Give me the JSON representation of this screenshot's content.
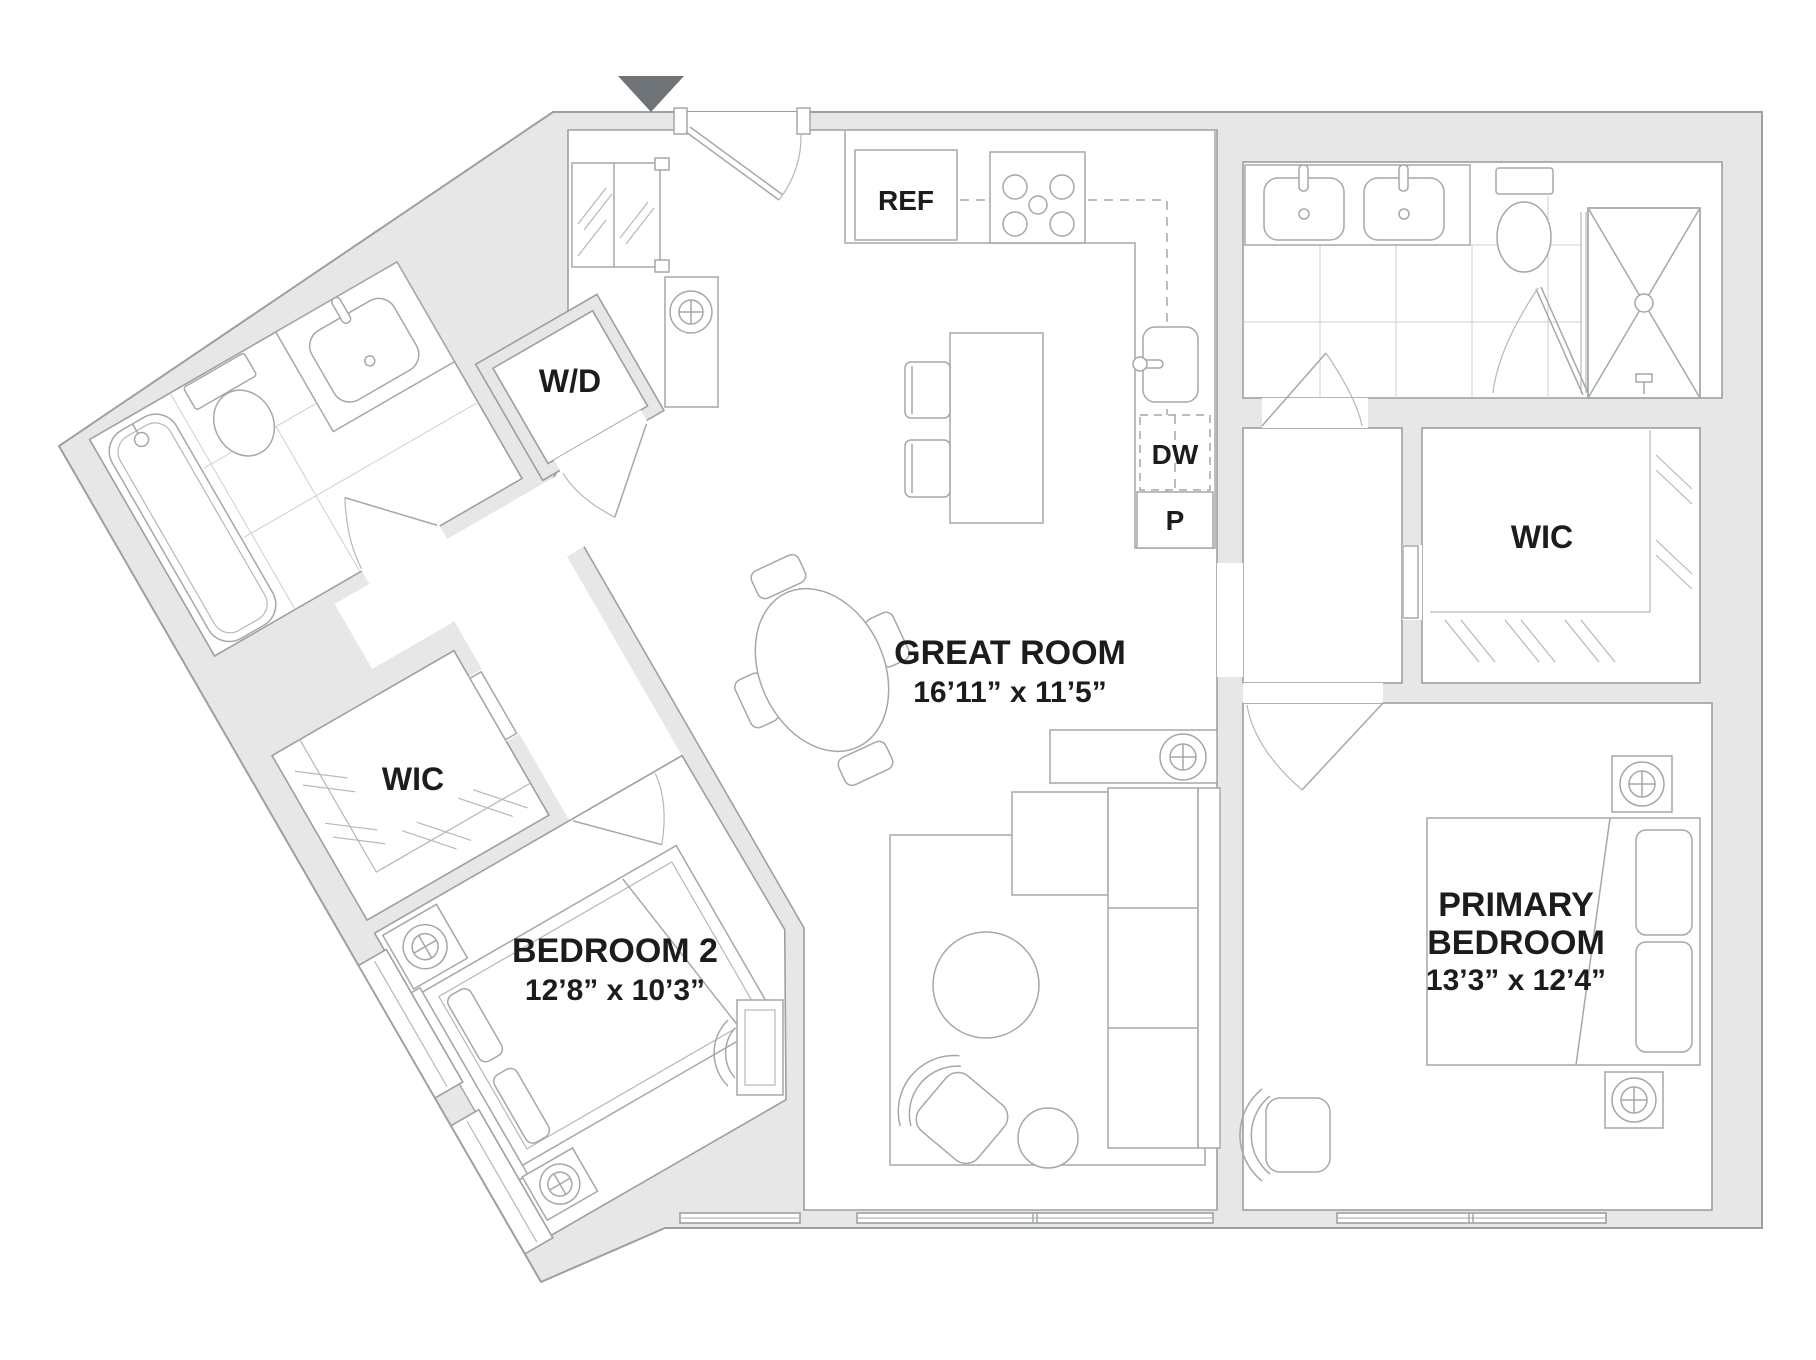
{
  "floor_plan": {
    "rooms": {
      "great_room": {
        "name": "GREAT ROOM",
        "dimensions": "16’11” x 11’5”"
      },
      "bedroom_2": {
        "name": "BEDROOM 2",
        "dimensions": "12’8” x 10’3”"
      },
      "primary_bedroom": {
        "name_line_1": "PRIMARY",
        "name_line_2": "BEDROOM",
        "dimensions": "13’3” x 12’4”"
      },
      "primary_closet": {
        "name": "WIC"
      },
      "bedroom_2_closet": {
        "name": "WIC"
      }
    },
    "fixtures": {
      "refrigerator": "REF",
      "dishwasher": "DW",
      "pantry": "P",
      "washer_dryer": "W/D"
    },
    "colors": {
      "wall_fill": "#e7e7e7",
      "line": "#9aa0a4",
      "tile_line": "#cdd0d2",
      "label_text": "#1c1c1e",
      "entry_marker": "#6e7377"
    }
  }
}
